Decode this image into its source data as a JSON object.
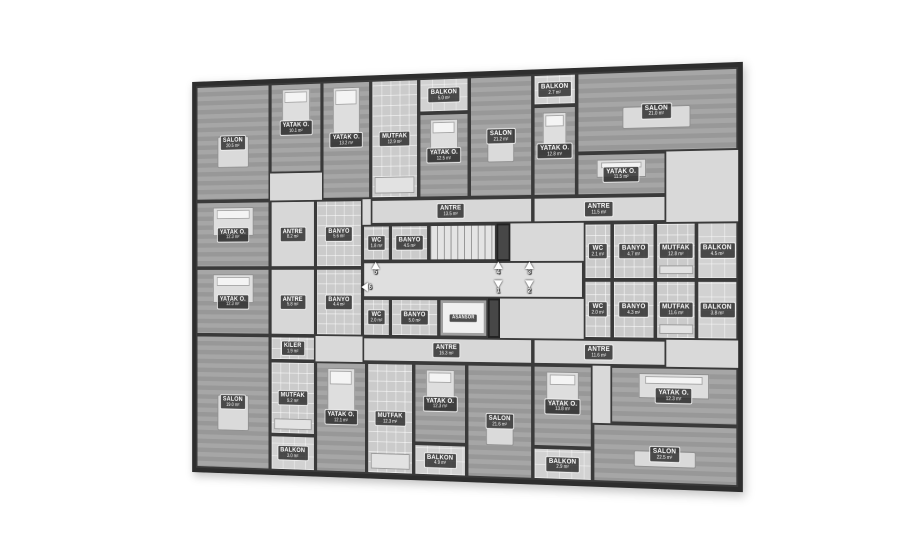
{
  "plan": {
    "wall_color": "#2e2e2e",
    "floor_base_color": "#d9d9d9",
    "elevator_label": "ASANSÖR",
    "unit_markers": [
      {
        "n": "1",
        "dir": "down",
        "x": 372,
        "y": 226
      },
      {
        "n": "2",
        "dir": "down",
        "x": 408,
        "y": 226
      },
      {
        "n": "3",
        "dir": "up",
        "x": 408,
        "y": 206
      },
      {
        "n": "4",
        "dir": "up",
        "x": 372,
        "y": 206
      },
      {
        "n": "5",
        "dir": "up",
        "x": 226,
        "y": 206
      },
      {
        "n": "6",
        "dir": "left",
        "x": 215,
        "y": 226
      }
    ],
    "rooms": [
      {
        "label": "SALON",
        "area": "20.5 m²",
        "type": "living",
        "rect": [
          0,
          0,
          95,
          130
        ]
      },
      {
        "label": "YATAK O.",
        "area": "10.1 m²",
        "type": "bed",
        "rect": [
          95,
          0,
          65,
          100
        ]
      },
      {
        "label": "YATAK O.",
        "area": "13.2 m²",
        "type": "bed",
        "rect": [
          160,
          0,
          60,
          130
        ]
      },
      {
        "label": "MUTFAK",
        "area": "12.9 m²",
        "type": "kitchen",
        "rect": [
          220,
          0,
          58,
          130
        ]
      },
      {
        "label": "BALKON",
        "area": "5.0 m²",
        "type": "balcony",
        "rect": [
          278,
          0,
          60,
          38
        ]
      },
      {
        "label": "YATAK O.",
        "area": "12.5 m²",
        "type": "bed",
        "rect": [
          278,
          38,
          60,
          92
        ]
      },
      {
        "label": "SALON",
        "area": "21.2 m²",
        "type": "living",
        "rect": [
          338,
          0,
          74,
          130
        ]
      },
      {
        "label": "BALKON",
        "area": "2.7 m²",
        "type": "balcony",
        "rect": [
          412,
          0,
          50,
          34
        ]
      },
      {
        "label": "YATAK O.",
        "area": "12.8 m²",
        "type": "bed",
        "rect": [
          412,
          34,
          50,
          96
        ]
      },
      {
        "label": "SALON",
        "area": "21.0 m²",
        "type": "living",
        "rect": [
          462,
          0,
          178,
          85
        ]
      },
      {
        "label": "YATAK O.",
        "area": "11.5 m²",
        "type": "bed",
        "rect": [
          462,
          85,
          100,
          45
        ]
      },
      {
        "label": "ANTRE",
        "area": "13.5 m²",
        "type": "hall",
        "rect": [
          220,
          130,
          192,
          28
        ]
      },
      {
        "label": "ANTRE",
        "area": "11.5 m²",
        "type": "hall",
        "rect": [
          412,
          130,
          150,
          28
        ]
      },
      {
        "label": "YATAK O.",
        "area": "12.3 m²",
        "type": "bed",
        "rect": [
          0,
          130,
          95,
          75
        ]
      },
      {
        "label": "YATAK O.",
        "area": "12.3 m²",
        "type": "bed",
        "rect": [
          0,
          205,
          95,
          75
        ]
      },
      {
        "label": "ANTRE",
        "area": "8.2 m²",
        "type": "hall",
        "rect": [
          95,
          130,
          57,
          75
        ]
      },
      {
        "label": "BANYO",
        "area": "5.6 m²",
        "type": "wet",
        "rect": [
          152,
          130,
          58,
          75
        ]
      },
      {
        "label": "ANTRE",
        "area": "5.8 m²",
        "type": "hall",
        "rect": [
          95,
          205,
          57,
          75
        ]
      },
      {
        "label": "BANYO",
        "area": "4.4 m²",
        "type": "wet",
        "rect": [
          152,
          205,
          58,
          75
        ]
      },
      {
        "label": "KİLER",
        "area": "1.9 m²",
        "type": "wet",
        "rect": [
          95,
          280,
          57,
          28
        ]
      },
      {
        "label": "WC",
        "area": "1.8 m²",
        "type": "wet",
        "rect": [
          210,
          158,
          34,
          40
        ]
      },
      {
        "label": "BANYO",
        "area": "4.5 m²",
        "type": "wet",
        "rect": [
          244,
          158,
          46,
          40
        ]
      },
      {
        "label": "",
        "area": "",
        "type": "stairs",
        "rect": [
          290,
          158,
          80,
          40
        ]
      },
      {
        "label": "",
        "area": "",
        "type": "shaft",
        "rect": [
          370,
          158,
          16,
          40
        ]
      },
      {
        "label": "",
        "area": "",
        "type": "corridor",
        "rect": [
          210,
          198,
          260,
          40
        ]
      },
      {
        "label": "WC",
        "area": "2.0 m²",
        "type": "wet",
        "rect": [
          210,
          238,
          34,
          42
        ]
      },
      {
        "label": "BANYO",
        "area": "5.0 m²",
        "type": "wet",
        "rect": [
          244,
          238,
          58,
          42
        ]
      },
      {
        "label": "ASANSÖR",
        "area": "",
        "type": "elevator",
        "rect": [
          302,
          238,
          58,
          42
        ]
      },
      {
        "label": "",
        "area": "",
        "type": "shaft",
        "rect": [
          360,
          238,
          14,
          42
        ]
      },
      {
        "label": "WC",
        "area": "2.1 m²",
        "type": "wet",
        "rect": [
          470,
          158,
          32,
          60
        ]
      },
      {
        "label": "BANYO",
        "area": "4.7 m²",
        "type": "wet",
        "rect": [
          502,
          158,
          48,
          60
        ]
      },
      {
        "label": "MUTFAK",
        "area": "12.8 m²",
        "type": "kitchen",
        "rect": [
          550,
          158,
          45,
          60
        ]
      },
      {
        "label": "BALKON",
        "area": "4.5 m²",
        "type": "balcony",
        "rect": [
          595,
          158,
          45,
          60
        ]
      },
      {
        "label": "WC",
        "area": "2.0 m²",
        "type": "wet",
        "rect": [
          470,
          218,
          32,
          62
        ]
      },
      {
        "label": "BANYO",
        "area": "4.3 m²",
        "type": "wet",
        "rect": [
          502,
          218,
          48,
          62
        ]
      },
      {
        "label": "MUTFAK",
        "area": "11.6 m²",
        "type": "kitchen",
        "rect": [
          550,
          218,
          45,
          62
        ]
      },
      {
        "label": "BALKON",
        "area": "3.8 m²",
        "type": "balcony",
        "rect": [
          595,
          218,
          45,
          62
        ]
      },
      {
        "label": "ANTRE",
        "area": "16.3 m²",
        "type": "hall",
        "rect": [
          210,
          280,
          202,
          28
        ]
      },
      {
        "label": "ANTRE",
        "area": "11.6 m²",
        "type": "hall",
        "rect": [
          412,
          280,
          150,
          28
        ]
      },
      {
        "label": "SALON",
        "area": "19.0 m²",
        "type": "living",
        "rect": [
          0,
          280,
          95,
          150
        ]
      },
      {
        "label": "MUTFAK",
        "area": "9.2 m²",
        "type": "kitchen",
        "rect": [
          95,
          308,
          57,
          82
        ]
      },
      {
        "label": "BALKON",
        "area": "3.0 m²",
        "type": "balcony",
        "rect": [
          95,
          390,
          57,
          40
        ]
      },
      {
        "label": "YATAK O.",
        "area": "12.1 m²",
        "type": "bed",
        "rect": [
          152,
          308,
          63,
          122
        ]
      },
      {
        "label": "MUTFAK",
        "area": "12.3 m²",
        "type": "kitchen",
        "rect": [
          215,
          308,
          57,
          122
        ]
      },
      {
        "label": "YATAK O.",
        "area": "12.3 m²",
        "type": "bed",
        "rect": [
          272,
          308,
          63,
          87
        ]
      },
      {
        "label": "BALKON",
        "area": "4.9 m²",
        "type": "balcony",
        "rect": [
          272,
          395,
          63,
          35
        ]
      },
      {
        "label": "SALON",
        "area": "21.6 m²",
        "type": "living",
        "rect": [
          335,
          308,
          77,
          122
        ]
      },
      {
        "label": "YATAK O.",
        "area": "13.8 m²",
        "type": "bed",
        "rect": [
          412,
          308,
          68,
          87
        ]
      },
      {
        "label": "BALKON",
        "area": "2.9 m²",
        "type": "balcony",
        "rect": [
          412,
          395,
          68,
          35
        ]
      },
      {
        "label": "YATAK O.",
        "area": "12.3 m²",
        "type": "bed",
        "rect": [
          500,
          308,
          140,
          60
        ]
      },
      {
        "label": "SALON",
        "area": "22.5 m²",
        "type": "living",
        "rect": [
          480,
          368,
          160,
          62
        ]
      }
    ]
  }
}
